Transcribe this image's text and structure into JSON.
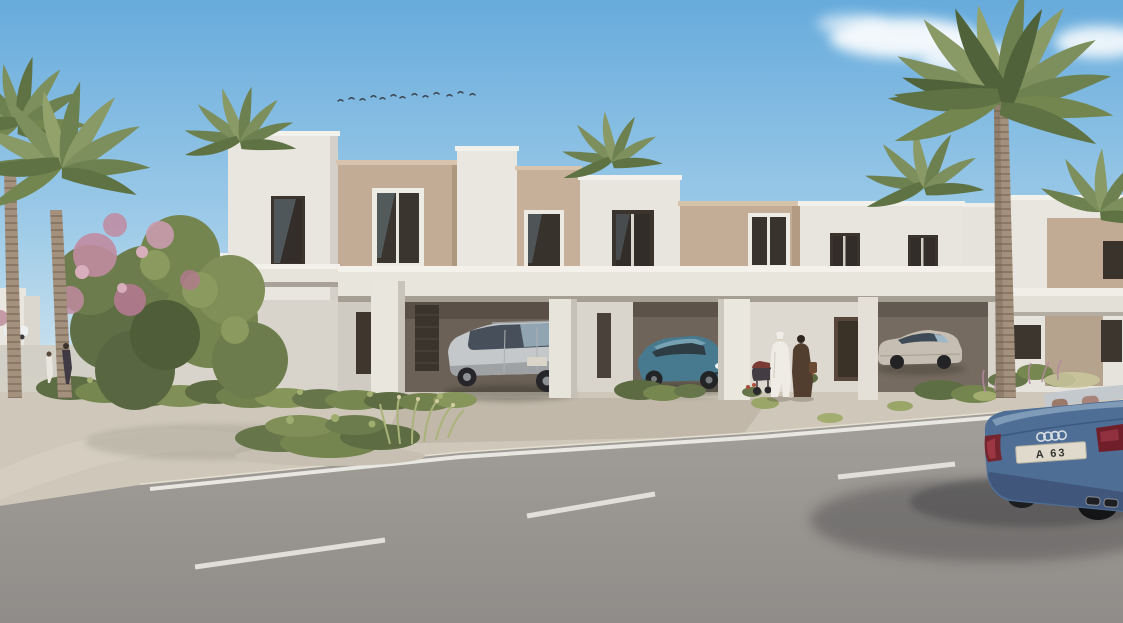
{
  "scene": {
    "title": "Townhouse community exterior rendering",
    "description": "Sunny daytime architectural rendering of a row of modern two-storey townhouses with carports, palm trees, landscaped shrubs, pedestrians in traditional dress, parked cars and a blue convertible driving past on the foreground road",
    "time_of_day": "day",
    "weather": "clear sky with small white clouds and a flock of birds"
  },
  "sky": {
    "cloud_count": 4,
    "bird_flock_count": 13
  },
  "buildings": {
    "style": "modern flat-roof townhouses",
    "storeys": 2,
    "visible_units": 5,
    "features": [
      "stepped parapets",
      "tan accent panels",
      "dark framed windows",
      "continuous white carport canopy",
      "louvered screens",
      "recessed entry doors"
    ]
  },
  "vehicles": [
    {
      "name": "silver-suv",
      "type": "SUV",
      "color": "silver",
      "location": "left carport"
    },
    {
      "name": "teal-sports-sedan",
      "type": "sports sedan",
      "color": "teal blue",
      "location": "centre carport"
    },
    {
      "name": "champagne-sedan",
      "type": "luxury sedan",
      "color": "champagne silver",
      "location": "right carport"
    },
    {
      "name": "blue-convertible",
      "type": "convertible with light spoiler",
      "color": "steel blue",
      "badge": "audi-rings",
      "license_plate": "A 63",
      "location": "foreground road, driving right"
    }
  ],
  "people": [
    {
      "name": "man-in-white-kandura",
      "description": "man in white kandura walking"
    },
    {
      "name": "woman-in-dark-abaya",
      "description": "woman in dark abaya beside him"
    },
    {
      "name": "stroller",
      "description": "baby stroller with maroon canopy"
    },
    {
      "name": "distant-pedestrians",
      "description": "two pedestrians on the left walkway"
    }
  ],
  "vegetation": {
    "palms_left": 3,
    "palm_right": 1,
    "roof_palm_heads": 3,
    "flowering_tree": "green canopy with pink blossoms",
    "shrubs": "low green shrubs along facades and a planted island",
    "grasses": "wispy ornamental grasses, some with purple plumes"
  },
  "road": {
    "surface": "grey asphalt",
    "edge_line": "solid white line along kerb",
    "lane_marking": "dashed white centre line",
    "dash_count": 3
  },
  "palette": {
    "sky_top": "#67abdc",
    "sky_horizon": "#d9e8ef",
    "wall_white": "#e9e6df",
    "wall_tan": "#c3ac95",
    "canopy_white": "#e8e5dd",
    "carport_shadow": "#6b6157",
    "window_glass": "#37322c",
    "road": "#9b9793",
    "sidewalk": "#cfc8ba",
    "marking_white": "#ecebe6",
    "foliage_green": "#74854f",
    "blossom_pink": "#c08ba0",
    "palm_frond": "#7d8f5c",
    "palm_trunk": "#a3917e",
    "suv_silver": "#c5c8ca",
    "porsche_teal": "#47798f",
    "sedan_champagne": "#c6beb2",
    "audi_blue": "#4e6e96"
  }
}
